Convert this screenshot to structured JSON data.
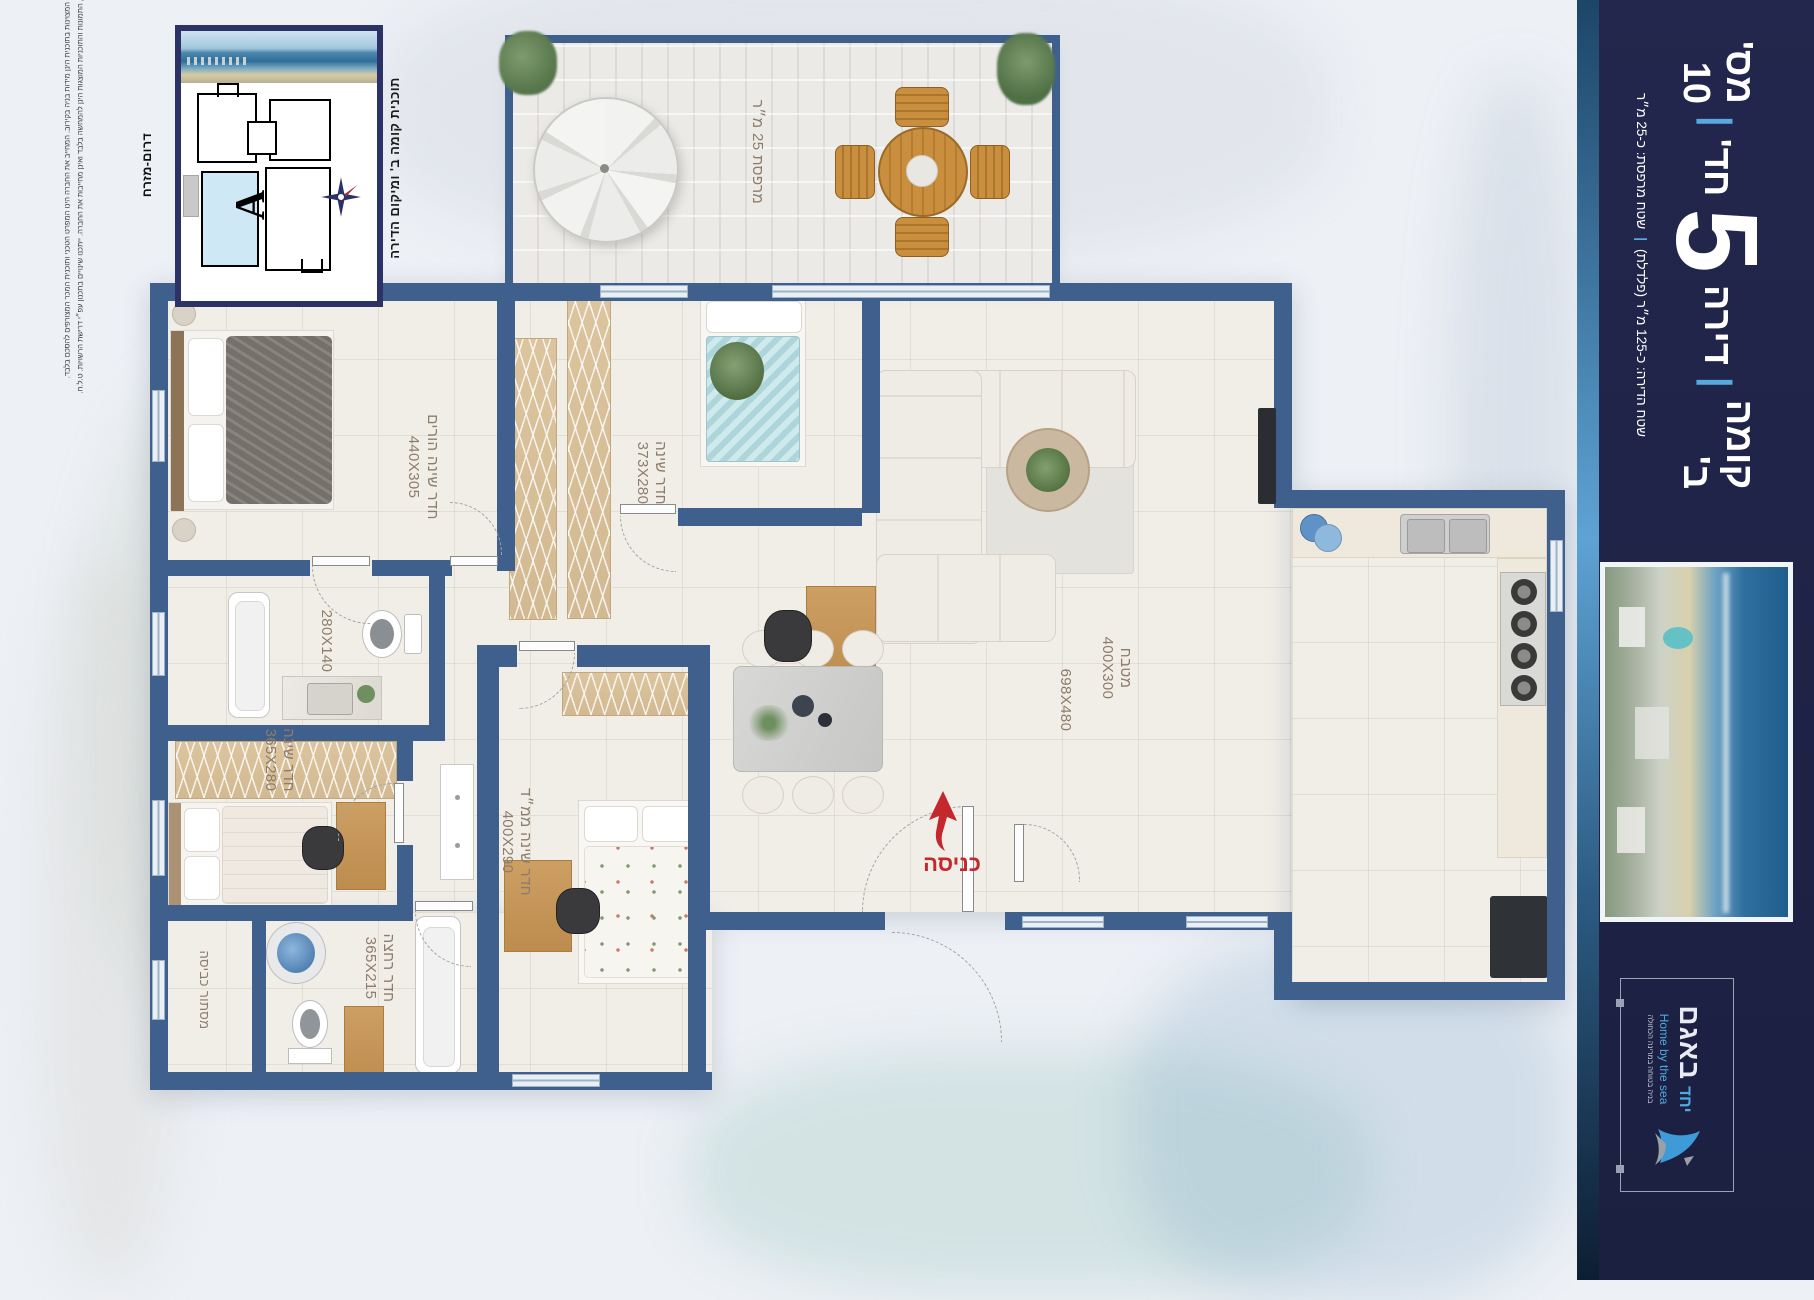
{
  "sidebar": {
    "floor": "קומה ב'",
    "sep": "|",
    "apartment_word": "דירה",
    "rooms_count": "5",
    "rooms_unit": "חד'",
    "apartment_number": "מס' 10",
    "area_apartment": "שטח הדירה: כ-125 מ״ר (פלדלת)",
    "area_balcony": "שטח מרפסת: כ-25 מ״ר"
  },
  "logo": {
    "brand_small": "יחד",
    "brand_large": "באגם",
    "tagline_en": "Home by the sea",
    "tagline_he": "בניה בטוחה במרינה הכחולה"
  },
  "inset": {
    "title": "תוכנית קומה ב' ומיקום הדירה",
    "orientation": "דרום-מזרח",
    "unit_letter": "A"
  },
  "disclaimer": {
    "line1": "כל ההדמיות, התמונות והתוכניות המוצגות הינן להמחשה בלבד ואינן מחייבות את החברה. ייתכנו שינויים בתכנון עפ״י דרישת הרשויות. ט.ל.ח.",
    "line2": "המידות המצוינות בתוכנית הינן מידות בניה בקירוב. המחייב את החברה הינו המפרט הטכני ותוכנית המכר המצורפים להסכם בלבד."
  },
  "plan": {
    "entrance_label": "כניסה",
    "balcony": {
      "label": "מרפסת 25 מ״ר"
    },
    "rooms": [
      {
        "name": "חדר שינה הורים",
        "dims": "440X305"
      },
      {
        "name": "חדר שינה",
        "dims": "373X280"
      },
      {
        "name": "",
        "dims": "280X140"
      },
      {
        "name": "חדר שינה",
        "dims": "365X280"
      },
      {
        "name": "חדר שינה ממ״ד",
        "dims": "400X290"
      },
      {
        "name": "",
        "dims": "698X480"
      },
      {
        "name": "מטבח",
        "dims": "400X300"
      },
      {
        "name": "חדר רחצה",
        "dims": "365X215"
      },
      {
        "name": "מסתור כביסה",
        "dims": ""
      }
    ]
  },
  "colors": {
    "wall": "#3f5f8d",
    "sidebar": "#1e2247",
    "accent_blue": "#57a8dc",
    "entrance_red": "#c4272c",
    "label": "#8d7c6b",
    "highlight_unit": "#cfe8f5"
  }
}
